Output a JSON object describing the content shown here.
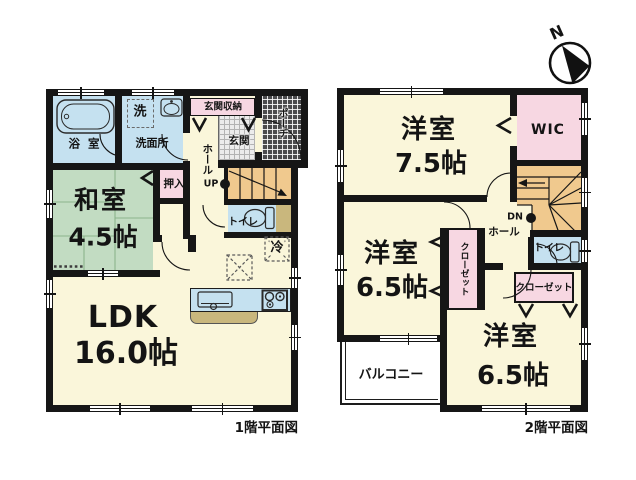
{
  "compass": {
    "north": "N"
  },
  "floor1": {
    "caption": "1階平面図",
    "labels": {
      "bath": "浴 室",
      "washer": "洗",
      "washroom": "洗面所",
      "entrance_storage": "玄関収納",
      "porch": "ポーチ",
      "entrance": "玄関",
      "hall": "ホール",
      "up": "UP",
      "oshiire": "押入",
      "washitsu_name": "和室",
      "washitsu_size": "4.5帖",
      "toilet": "トイレ",
      "fridge": "冷",
      "ldk_name": "LDK",
      "ldk_size": "16.0帖"
    }
  },
  "floor2": {
    "caption": "2階平面図",
    "labels": {
      "bedroom1_name": "洋室",
      "bedroom1_size": "7.5帖",
      "wic": "WIC",
      "dn": "DN",
      "hall": "ホール",
      "toilet": "トイレ",
      "closet_west": "クローゼット",
      "closet_south": "クローゼット",
      "bedroom2_name": "洋室",
      "bedroom2_size": "6.5帖",
      "bedroom3_name": "洋室",
      "bedroom3_size": "6.5帖",
      "balcony": "バルコニー"
    }
  },
  "colors": {
    "wall": "#161616",
    "floor_cream": "#FAF6DA",
    "tatami_green": "#C2DCC2",
    "water_blue": "#C5E1F0",
    "storage_pink": "#F7D7E2",
    "stair_orange": "#F0C98E",
    "counter_tan": "#C9B77D",
    "porch_dark": "#4B4B4D",
    "entrance_gray": "#ECECEC"
  }
}
